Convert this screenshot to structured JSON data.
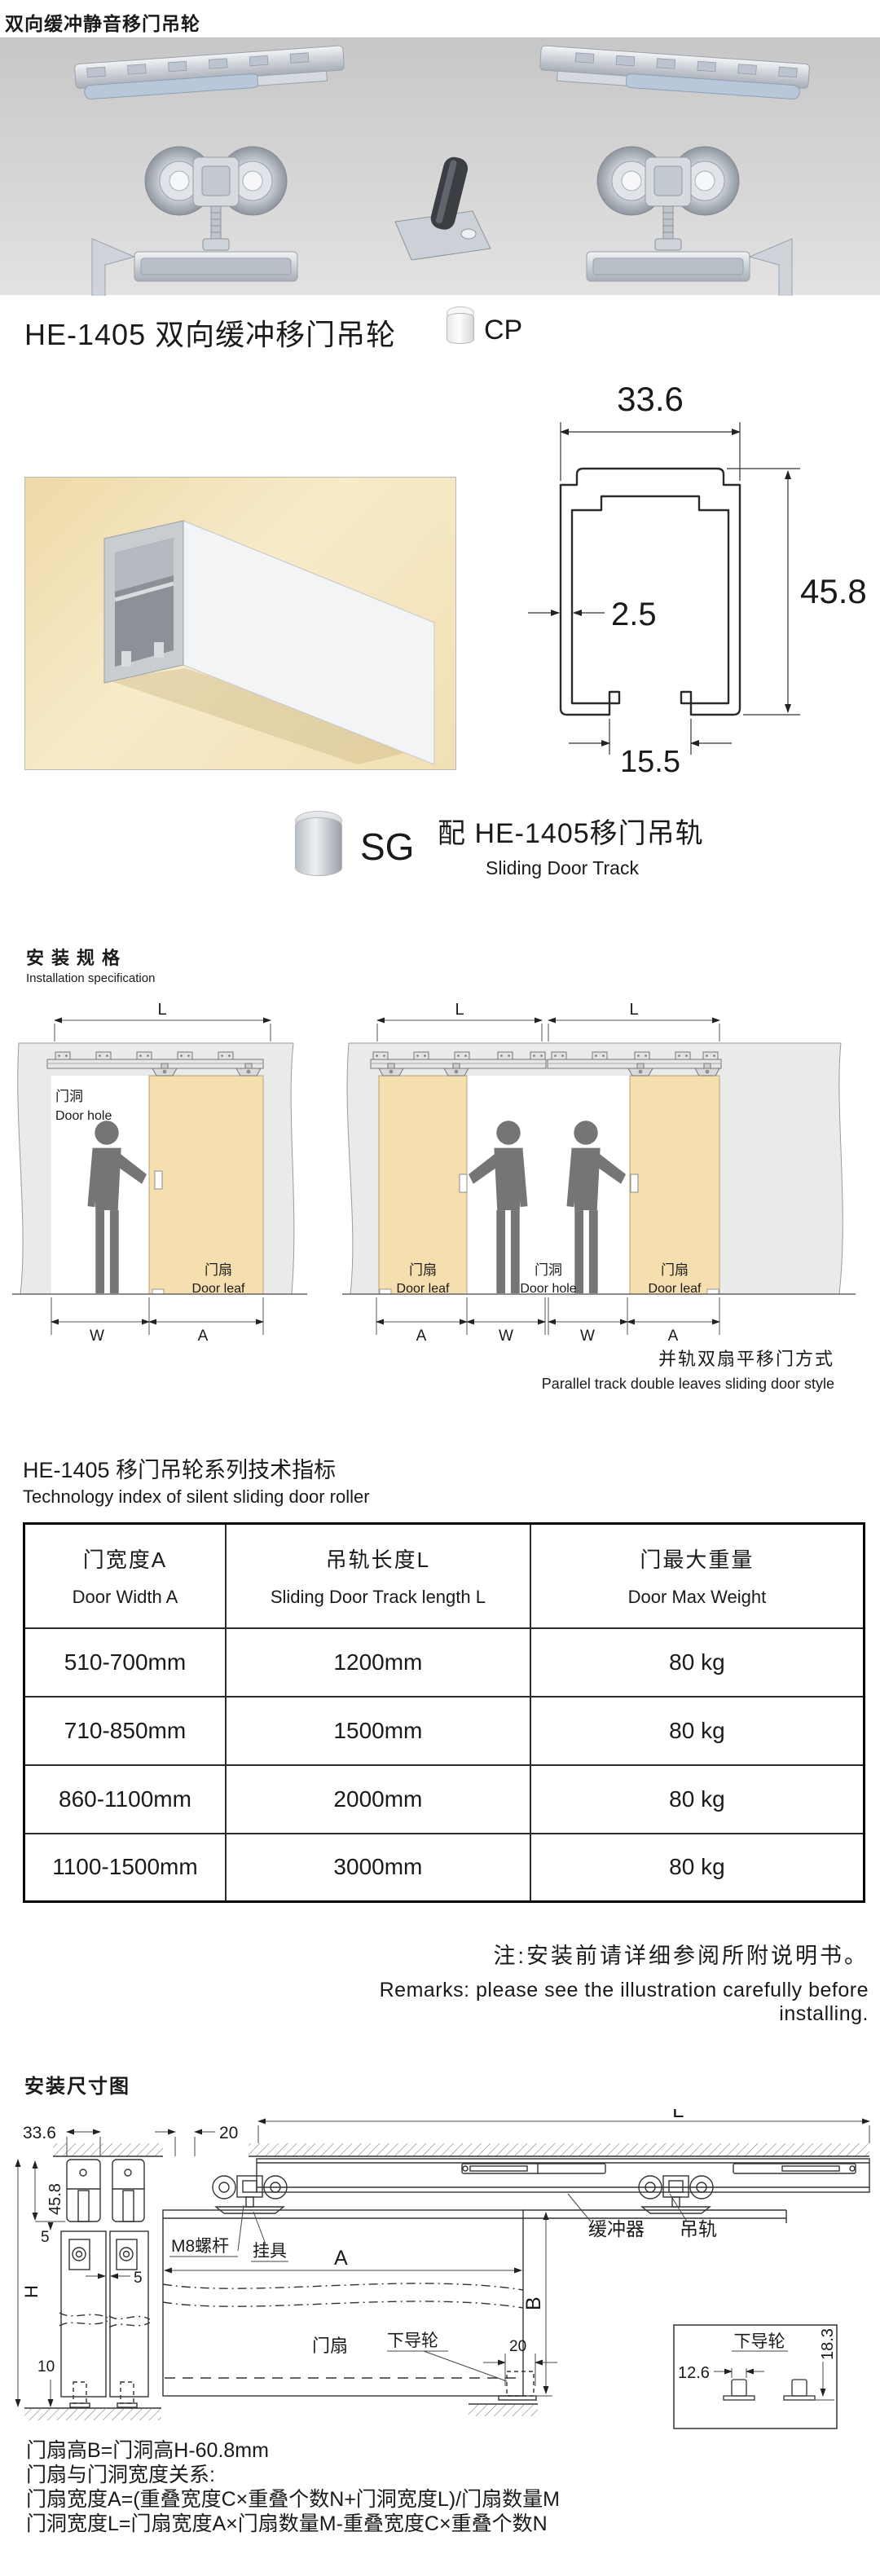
{
  "page": {
    "title": "双向缓冲静音移门吊轮"
  },
  "product": {
    "title": "HE-1405 双向缓冲移门吊轮",
    "cp_label": "CP",
    "sg_label": "SG",
    "track_title_cn": "配 HE-1405移门吊轨",
    "track_title_en": "Sliding Door Track"
  },
  "cross_section": {
    "width": "33.6",
    "height": "45.8",
    "thickness": "2.5",
    "opening": "15.5"
  },
  "installation": {
    "title_cn": "安装规格",
    "title_en": "Installation specification",
    "caption_cn": "并轨双扇平移门方式",
    "caption_en": "Parallel track double leaves sliding door style",
    "labels": {
      "dim_l": "L",
      "dim_w": "W",
      "dim_a": "A",
      "door_hole_cn": "门洞",
      "door_hole_en": "Door hole",
      "door_leaf_cn": "门扇",
      "door_leaf_en": "Door leaf"
    }
  },
  "tech_table": {
    "title_cn": "HE-1405 移门吊轮系列技术指标",
    "title_en": "Technology index of  silent sliding door roller",
    "columns": [
      {
        "cn": "门宽度A",
        "en": "Door Width A"
      },
      {
        "cn": "吊轨长度L",
        "en": "Sliding Door Track length L"
      },
      {
        "cn": "门最大重量",
        "en": "Door Max Weight"
      }
    ],
    "rows": [
      [
        "510-700mm",
        "1200mm",
        "80 kg"
      ],
      [
        "710-850mm",
        "1500mm",
        "80 kg"
      ],
      [
        "860-1100mm",
        "2000mm",
        "80 kg"
      ],
      [
        "1100-1500mm",
        "3000mm",
        "80 kg"
      ]
    ]
  },
  "remarks": {
    "cn": "注:安装前请详细参阅所附说明书。",
    "en": "Remarks: please see the illustration carefully before installing."
  },
  "install_diagram": {
    "title": "安装尺寸图",
    "dims": {
      "track_width": "33.6",
      "offset_20": "20",
      "length_l": "L",
      "track_height": "45.8",
      "gap_top": "5",
      "gap_mid": "5",
      "height_h": "H",
      "gap_bottom": "10",
      "door_width_a": "A",
      "door_height_b": "B",
      "guide_20": "20",
      "guide_width": "12.6",
      "guide_height": "18.3"
    },
    "labels": {
      "m8": "M8螺杆",
      "hanger": "挂具",
      "buffer": "缓冲器",
      "track": "吊轨",
      "door_leaf": "门扇",
      "bottom_guide": "下导轮",
      "inset_title": "下导轮"
    }
  },
  "formulas": {
    "line1": "门扇高B=门洞高H-60.8mm",
    "line2": "门扇与门洞宽度关系:",
    "line3": "门扇宽度A=(重叠宽度C×重叠个数N+门洞宽度L)/门扇数量M",
    "line4": "门洞宽度L=门扇宽度A×门扇数量M-重叠宽度C×重叠个数N"
  },
  "colors": {
    "door_leaf": "#f6dfae",
    "wall": "#eaeaea",
    "banner": "#d3d3d3",
    "photo_bg": "#f4e2b5"
  }
}
